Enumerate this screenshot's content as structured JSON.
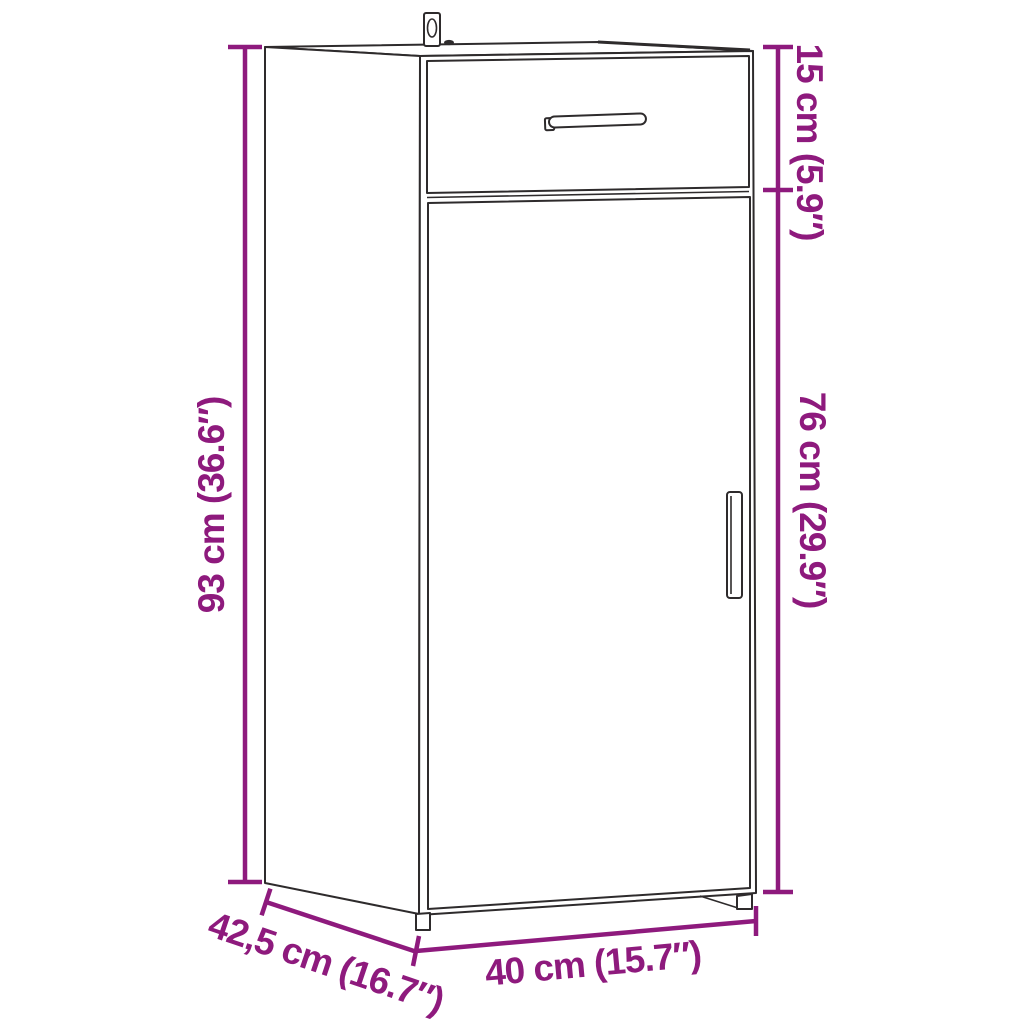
{
  "page": {
    "background_color": "#ffffff"
  },
  "diagram": {
    "accent_color": "#8e1a7d",
    "line_color": "#2e2b2c",
    "labels": {
      "overall_height": "93 cm (36.6″)",
      "top_section_height": "15 cm (5.9″)",
      "lower_section_height": "76 cm (29.9″)",
      "width": "40 cm (15.7″)",
      "depth": "42,5 cm (16.7″)"
    }
  }
}
